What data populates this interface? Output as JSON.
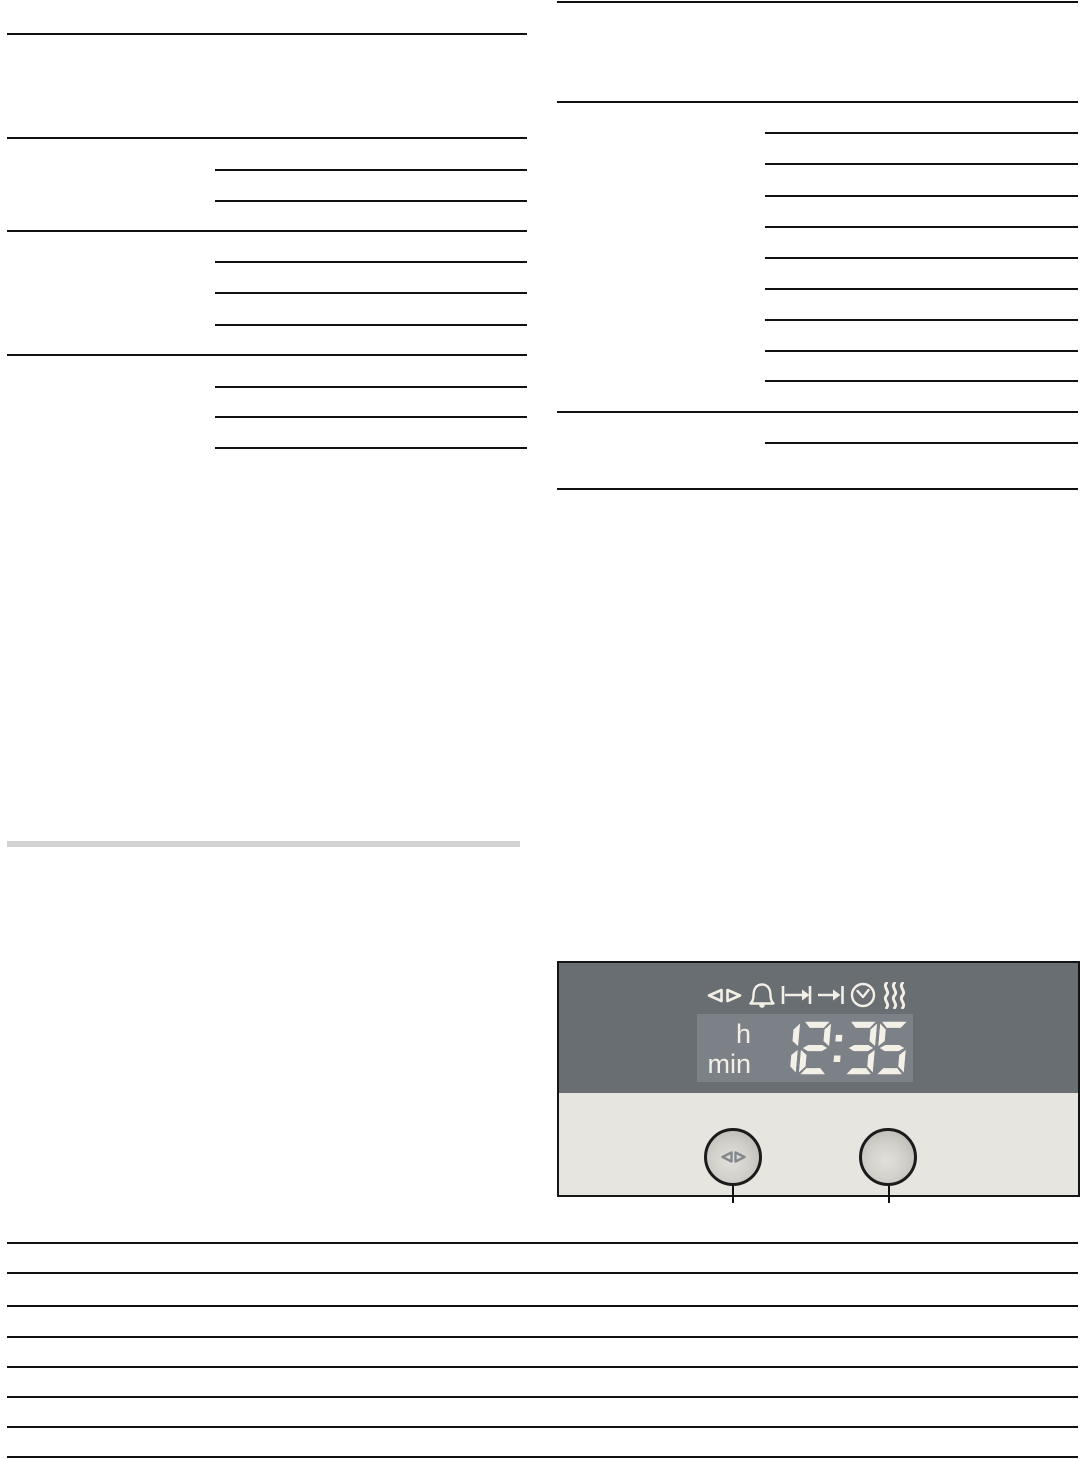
{
  "panel": {
    "display": {
      "hour_label": "h",
      "minute_label": "min",
      "time": "12:35"
    },
    "icons": [
      {
        "name": "select-keys-icon"
      },
      {
        "name": "timer-bell-icon"
      },
      {
        "name": "duration-icon"
      },
      {
        "name": "end-time-icon"
      },
      {
        "name": "clock-icon"
      },
      {
        "name": "steam-icon"
      }
    ],
    "colors": {
      "panel_dark": "#696e73",
      "panel_light": "#e7e5e0",
      "lcd": "#7c8187",
      "digit": "#f3f0e8",
      "icon": "#f2efe7",
      "rule": "#111111",
      "divider_bar": "#d3d3d3",
      "button_border": "#1b1b1b",
      "button_symbol": "#84888d"
    }
  }
}
